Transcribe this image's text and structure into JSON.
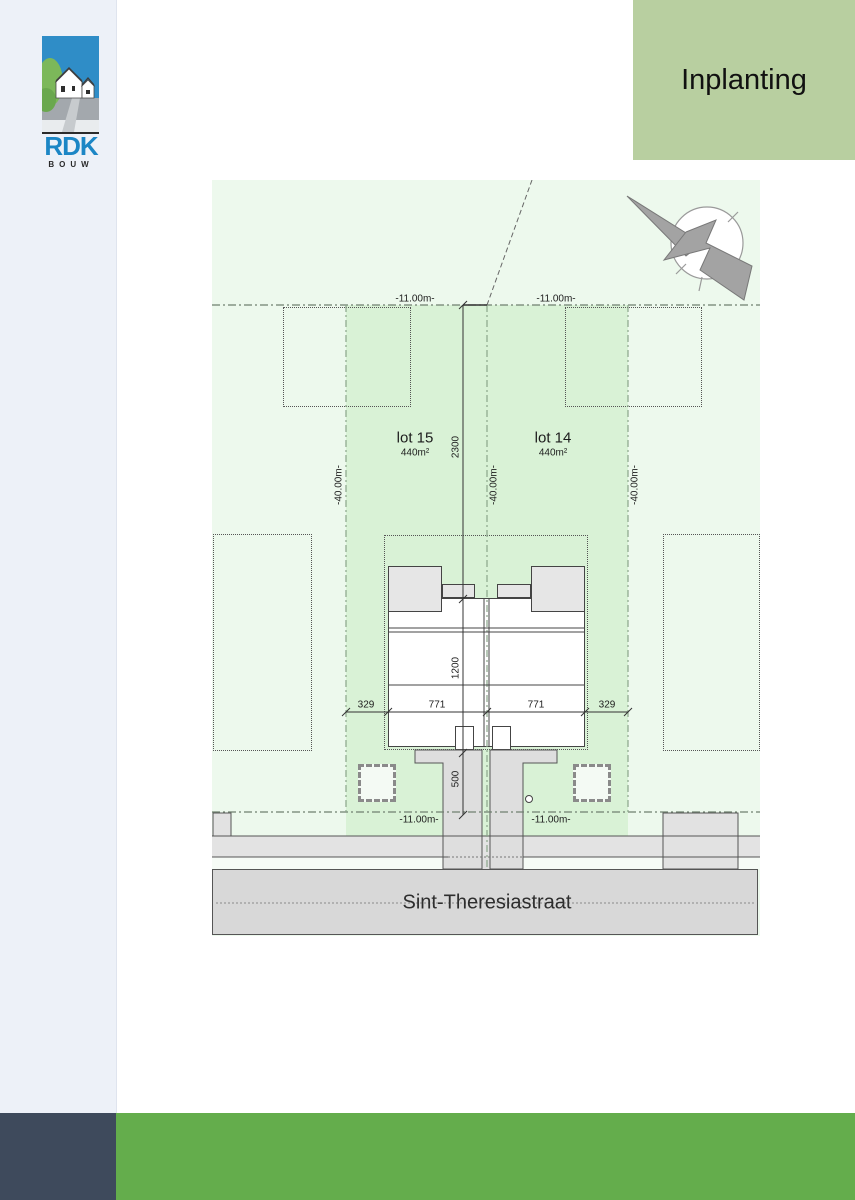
{
  "branding": {
    "name": "RDK",
    "sub": "BOUW"
  },
  "header": {
    "title": "Inplanting"
  },
  "plan": {
    "lots": [
      {
        "name": "lot 15",
        "area": "440m²"
      },
      {
        "name": "lot 14",
        "area": "440m²"
      }
    ],
    "street": {
      "name": "Sint-Theresiastraat"
    },
    "dims": {
      "rear_left": "-11.00m-",
      "rear_right": "-11.00m-",
      "front_left": "-11.00m-",
      "front_right": "-11.00m-",
      "depth_left": "-40.00m-",
      "depth_center": "-40.00m-",
      "depth_right": "-40.00m-",
      "rear_to_house": "2300",
      "house_depth": "1200",
      "front_garden": "500",
      "side_left": "329",
      "house_left": "771",
      "house_right": "771",
      "side_right": "329"
    },
    "colors": {
      "site_green": "#edf9ed",
      "lot_green": "#d9f2d6",
      "street_gray": "#d8d8d8",
      "header_green": "#b8cfa0",
      "footer_green": "#64ad4c",
      "footer_dark": "#3e4a5c",
      "logo_blue": "#2f8dc7"
    }
  }
}
